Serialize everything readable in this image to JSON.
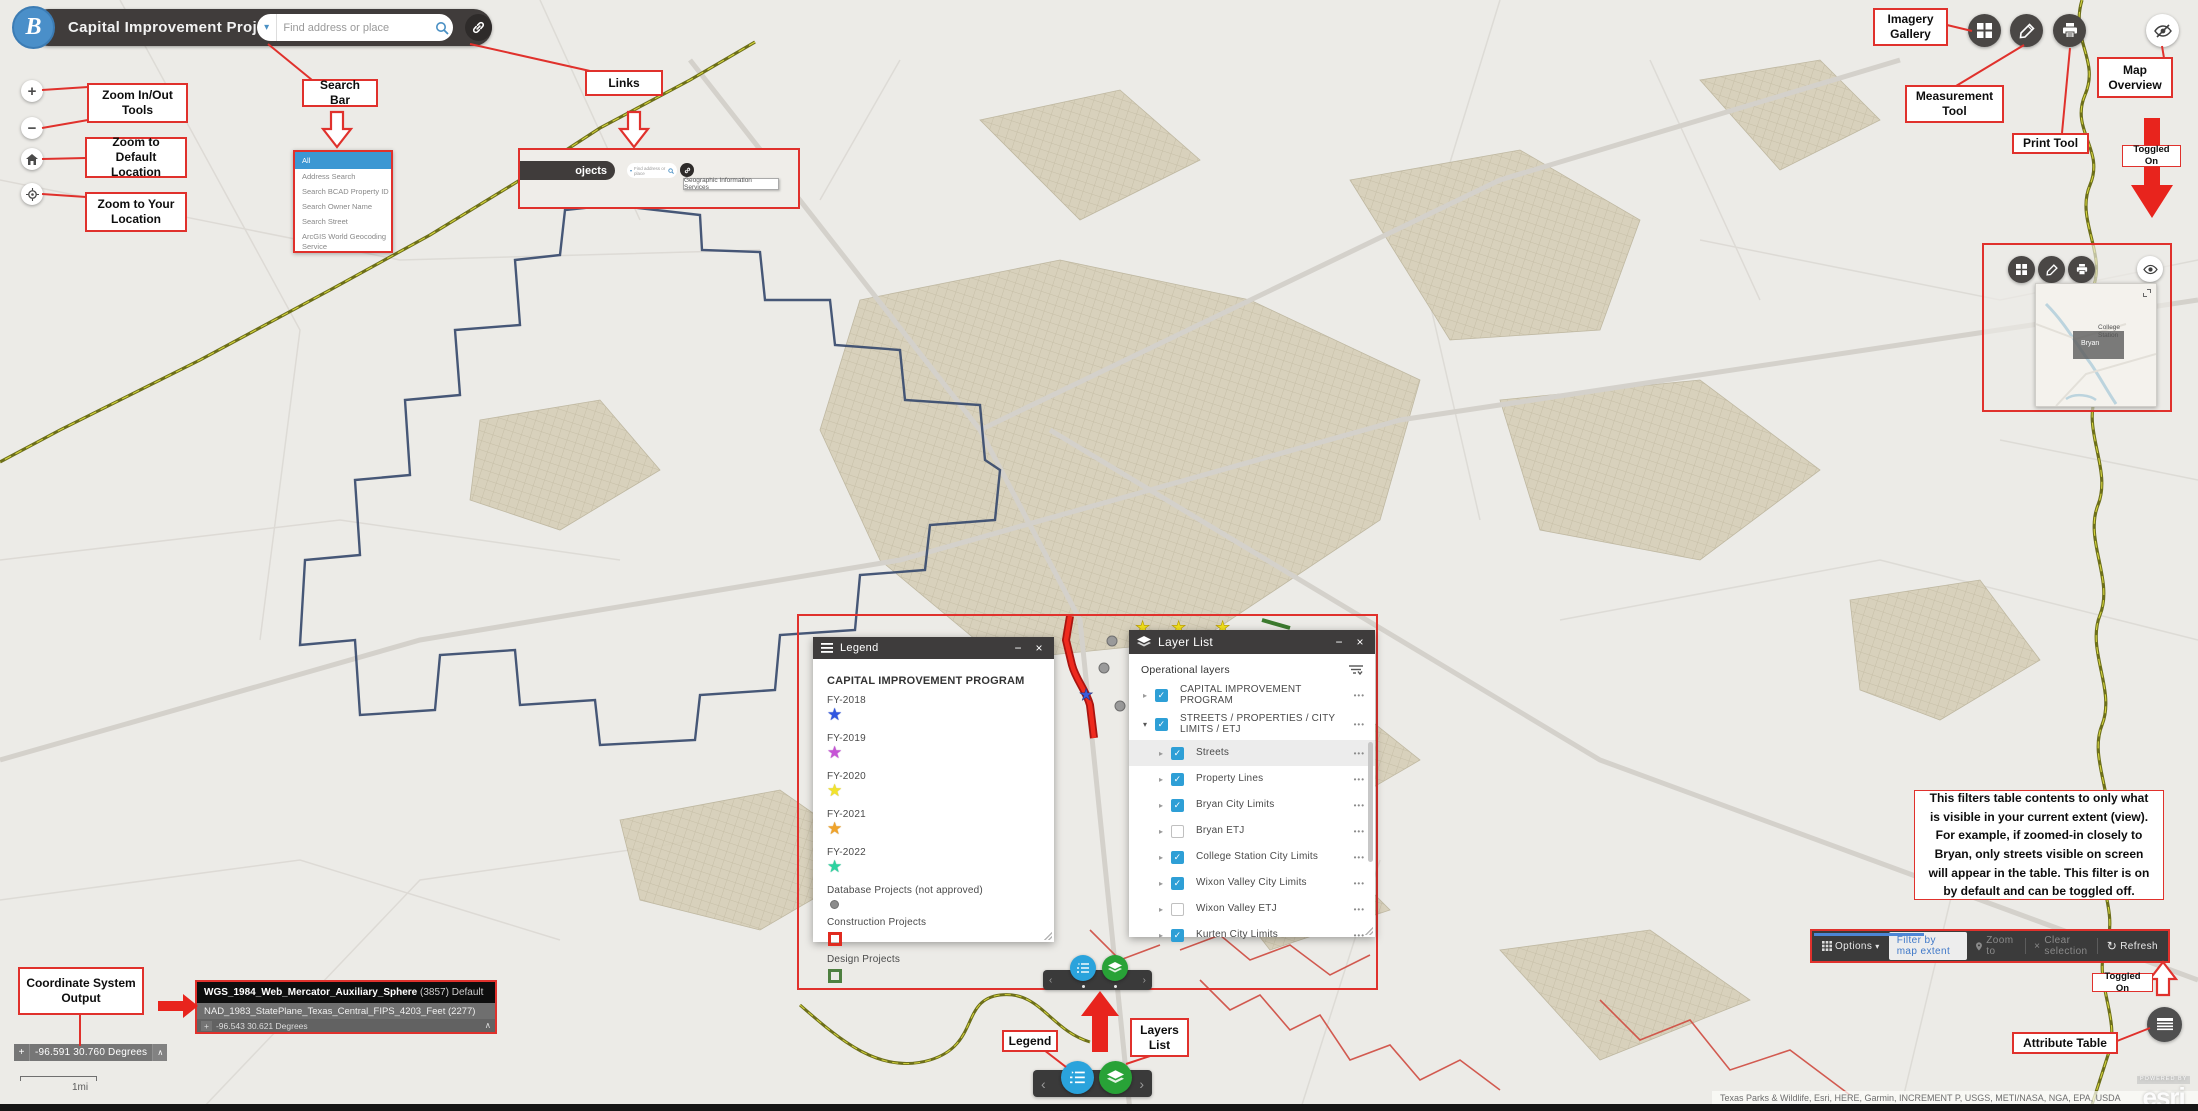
{
  "app": {
    "title": "Capital Improvement Projects",
    "logo_letter": "B",
    "search_placeholder": "Find address or place"
  },
  "callouts": {
    "zoom_in_out": "Zoom In/Out Tools",
    "zoom_default": "Zoom to Default Location",
    "zoom_your": "Zoom to Your Location",
    "search_bar": "Search Bar",
    "links": "Links",
    "imagery_gallery": "Imagery Gallery",
    "measurement_tool": "Measurement Tool",
    "print_tool": "Print Tool",
    "map_overview": "Map Overview",
    "toggled_on_top": "Toggled On",
    "coordinate_system_output": "Coordinate System Output",
    "legend": "Legend",
    "layers_list": "Layers List",
    "toggled_on_bottom": "Toggled On",
    "attribute_table": "Attribute Table",
    "filter_note": "This filters table contents to only what is visible in your current extent (view). For example, if zoomed-in closely to Bryan, only streets visible on screen will appear in the table. This filter is on by default and can be toggled off."
  },
  "search_dropdown": {
    "items": [
      "All",
      "Address Search",
      "Search BCAD Property ID",
      "Search Owner Name",
      "Search Street",
      "ArcGIS World Geocoding Service"
    ]
  },
  "links_inset": {
    "partial_title": "ojects",
    "search_placeholder": "Find address or place",
    "tooltip": "Geographic Information Services"
  },
  "legend_window": {
    "title": "Legend",
    "heading": "CAPITAL IMPROVEMENT PROGRAM",
    "items": [
      {
        "label": "FY-2018",
        "symbol": "star",
        "color": "#2f55e0"
      },
      {
        "label": "FY-2019",
        "symbol": "star",
        "color": "#c653d6"
      },
      {
        "label": "FY-2020",
        "symbol": "star",
        "color": "#f2e32b"
      },
      {
        "label": "FY-2021",
        "symbol": "star",
        "color": "#f0a32a"
      },
      {
        "label": "FY-2022",
        "symbol": "star",
        "color": "#2bd3a0"
      },
      {
        "label": "Database Projects (not approved)",
        "symbol": "circle",
        "color": "#8c8c8c"
      },
      {
        "label": "Construction Projects",
        "symbol": "square",
        "color": "#e02b20"
      },
      {
        "label": "Design Projects",
        "symbol": "square",
        "color": "#4e8040"
      }
    ]
  },
  "layer_list_window": {
    "title": "Layer List",
    "section_label": "Operational layers",
    "layers": [
      {
        "label": "CAPITAL IMPROVEMENT PROGRAM",
        "checked": true
      },
      {
        "label": "STREETS / PROPERTIES / CITY LIMITS / ETJ",
        "checked": true
      },
      {
        "label": "Streets",
        "checked": true,
        "highlighted": true
      },
      {
        "label": "Property Lines",
        "checked": true
      },
      {
        "label": "Bryan City Limits",
        "checked": true
      },
      {
        "label": "Bryan ETJ",
        "checked": false
      },
      {
        "label": "College Station City Limits",
        "checked": true
      },
      {
        "label": "Wixon Valley City Limits",
        "checked": true
      },
      {
        "label": "Wixon Valley ETJ",
        "checked": false
      },
      {
        "label": "Kurten City Limits",
        "checked": true
      }
    ]
  },
  "table_bar": {
    "options": "Options",
    "filter_extent": "Filter by map extent",
    "zoom_to": "Zoom to",
    "clear_selection": "Clear selection",
    "refresh": "Refresh"
  },
  "coordinate_inset": {
    "row1_name": "WGS_1984_Web_Mercator_Auxiliary_Sphere",
    "row1_code": "(3857)",
    "row1_suffix": "Default",
    "row2": "NAD_1983_StatePlane_Texas_Central_FIPS_4203_Feet  (2277)",
    "row3": "-96.543 30.621 Degrees"
  },
  "coordinate_widget": {
    "value": "-96.591 30.760 Degrees"
  },
  "scale_bar": {
    "label": "1mi"
  },
  "overview_map": {
    "label_bryan": "Bryan",
    "label_college_station": "College Station"
  },
  "attribution": {
    "text": "Texas Parks & Wildlife, Esri, HERE, Garmin, INCREMENT P, USGS, METI/NASA, NGA, EPA, USDA",
    "powered_by": "POWERED BY",
    "brand": "esri"
  },
  "icons": {
    "caret_down": "▾",
    "expand_closed": "▸",
    "expand_open": "▾",
    "overflow": "•••",
    "minimize": "−",
    "close": "×",
    "prev": "‹",
    "next": "›",
    "caret_up": "∧",
    "check": "✓",
    "star": "★",
    "refresh": "↻",
    "plus": "+",
    "minus": "−",
    "clear_x": "×",
    "crosshair": "+"
  },
  "colors": {
    "annotation_red": "#e0312c",
    "checkbox_blue": "#2e9fd6",
    "header_dark": "#403c3b",
    "highlight_blue": "#3b97d3",
    "carousel_blue": "#2aa3dc",
    "carousel_green": "#28a237",
    "titlebar_dark": "#3e3c3c",
    "city_limits_navy": "#374a6e",
    "etj_olive": "#7a7c1e"
  }
}
